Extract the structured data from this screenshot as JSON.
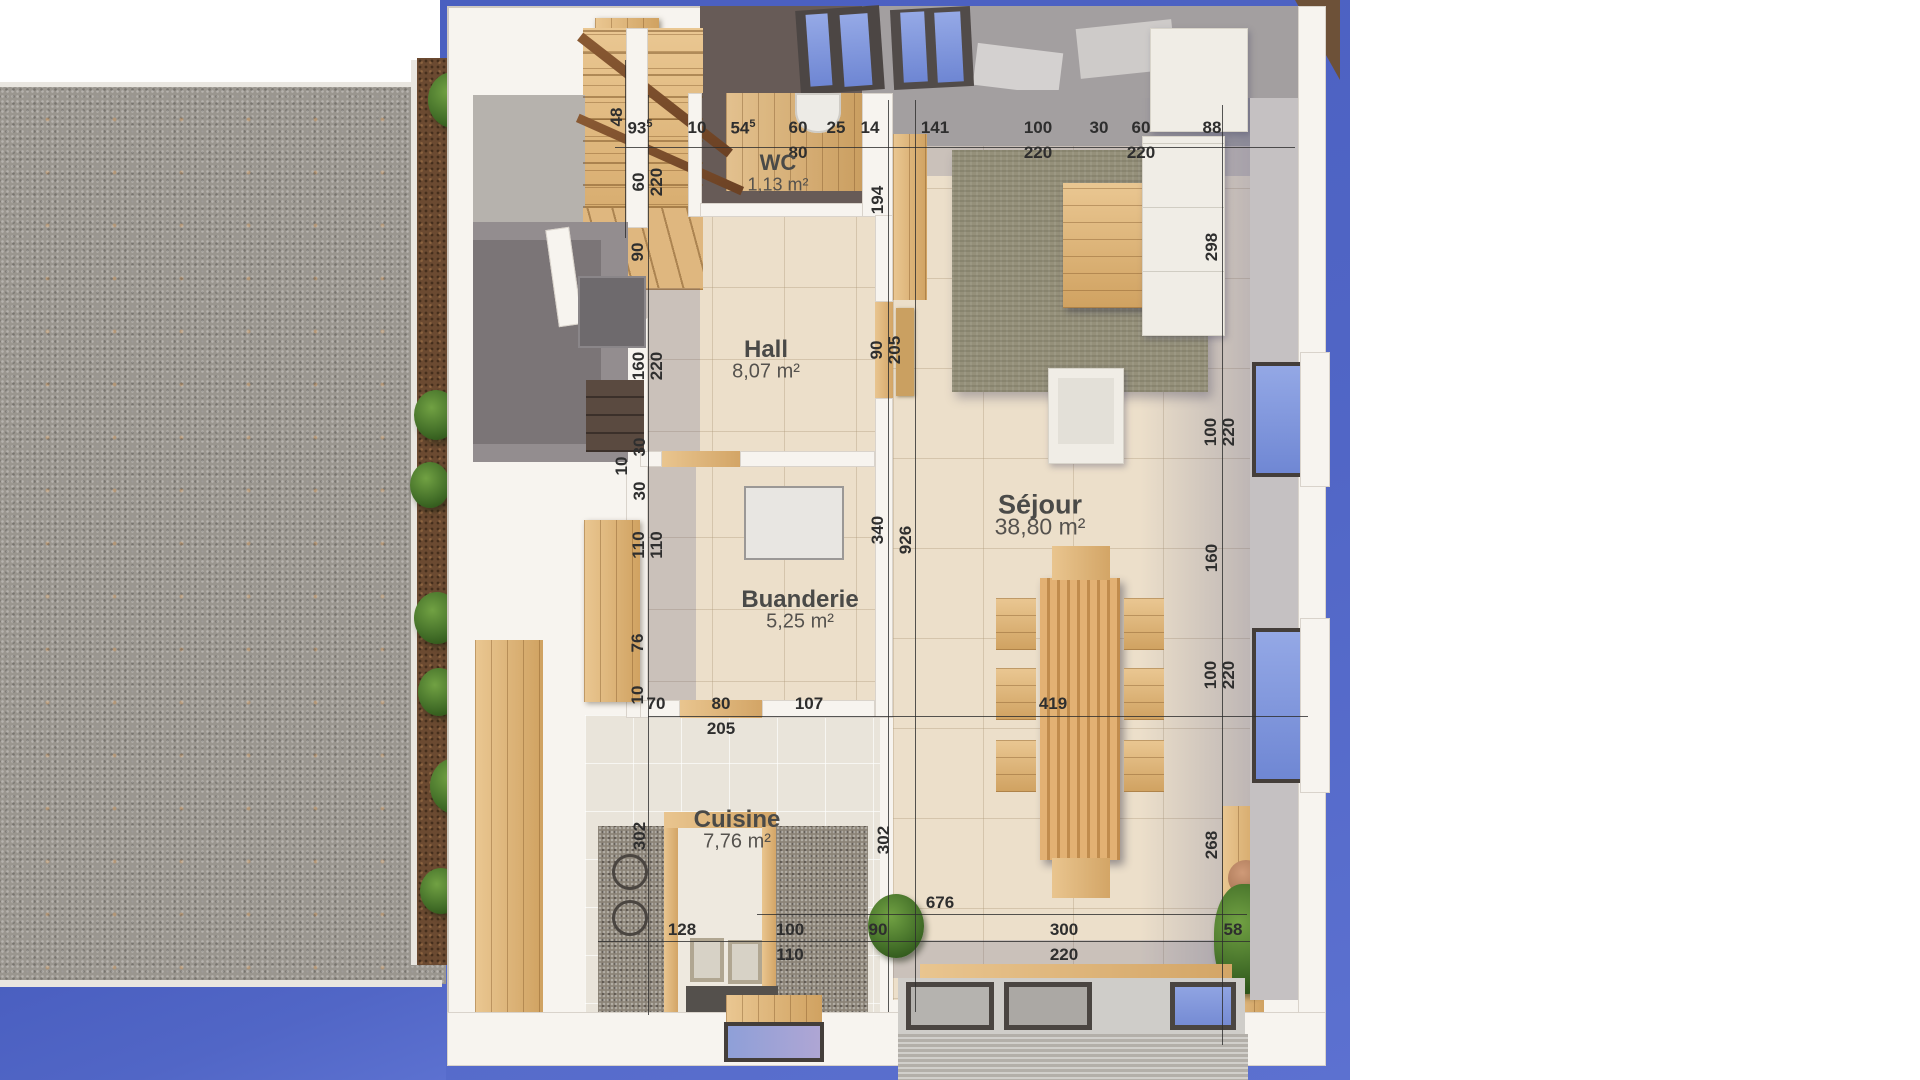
{
  "palette": {
    "blue": "#4e63c3",
    "gravel": "#9a968f",
    "wall_white": "#f7f4ef",
    "tile_beige": "#ecdfca",
    "wood": "#ddb27b",
    "granite": "#8c8478",
    "rug_olive": "#95907a",
    "glass_blue": "#8ba0e0",
    "dim_text": "#2e2e2e"
  },
  "rooms": [
    {
      "id": "wc",
      "name": "WC",
      "area": "1,13 m²",
      "cx": 778,
      "cy": 163,
      "fs": 22
    },
    {
      "id": "hall",
      "name": "Hall",
      "area": "8,07 m²",
      "cx": 766,
      "cy": 350,
      "fs": 24
    },
    {
      "id": "buanderie",
      "name": "Buanderie",
      "area": "5,25 m²",
      "cx": 800,
      "cy": 600,
      "fs": 24
    },
    {
      "id": "cuisine",
      "name": "Cuisine",
      "area": "7,76 m²",
      "cx": 737,
      "cy": 820,
      "fs": 24
    },
    {
      "id": "sejour",
      "name": "Séjour",
      "area": "38,80 m²",
      "cx": 1040,
      "cy": 505,
      "fs": 27
    }
  ],
  "dim_labels": [
    {
      "t": "93",
      "sup": "5",
      "x": 640,
      "y": 128
    },
    {
      "t": "10",
      "x": 697,
      "y": 128
    },
    {
      "t": "54",
      "sup": "5",
      "x": 743,
      "y": 128
    },
    {
      "t": "60",
      "x": 798,
      "y": 128,
      "b": "80"
    },
    {
      "t": "25",
      "x": 836,
      "y": 128
    },
    {
      "t": "14",
      "x": 870,
      "y": 128
    },
    {
      "t": "141",
      "x": 935,
      "y": 128
    },
    {
      "t": "100",
      "x": 1038,
      "y": 128,
      "b": "220"
    },
    {
      "t": "30",
      "x": 1099,
      "y": 128
    },
    {
      "t": "60",
      "x": 1141,
      "y": 128,
      "b": "220"
    },
    {
      "t": "88",
      "x": 1212,
      "y": 128
    },
    {
      "t": "48",
      "x": 617,
      "y": 117,
      "rot": 1
    },
    {
      "t": "60",
      "p": "220",
      "x": 648,
      "y": 182,
      "rot": 1
    },
    {
      "t": "90",
      "x": 638,
      "y": 252,
      "rot": 1
    },
    {
      "t": "160",
      "p": "220",
      "x": 648,
      "y": 366,
      "rot": 1
    },
    {
      "t": "30",
      "x": 640,
      "y": 447,
      "rot": 1
    },
    {
      "t": "10",
      "x": 622,
      "y": 466,
      "rot": 1
    },
    {
      "t": "30",
      "x": 640,
      "y": 491,
      "rot": 1
    },
    {
      "t": "110",
      "p": "110",
      "x": 648,
      "y": 545,
      "rot": 1
    },
    {
      "t": "76",
      "x": 638,
      "y": 643,
      "rot": 1
    },
    {
      "t": "10",
      "x": 638,
      "y": 695,
      "rot": 1
    },
    {
      "t": "302",
      "x": 640,
      "y": 836,
      "rot": 1
    },
    {
      "t": "194",
      "x": 878,
      "y": 200,
      "rot": 1
    },
    {
      "t": "90",
      "p": "205",
      "x": 886,
      "y": 350,
      "rot": 1
    },
    {
      "t": "340",
      "x": 878,
      "y": 530,
      "rot": 1
    },
    {
      "t": "302",
      "x": 884,
      "y": 840,
      "rot": 1
    },
    {
      "t": "926",
      "x": 906,
      "y": 540,
      "rot": 1
    },
    {
      "t": "298",
      "x": 1212,
      "y": 247,
      "rot": 1
    },
    {
      "t": "100",
      "p": "220",
      "x": 1220,
      "y": 432,
      "rot": 1
    },
    {
      "t": "160",
      "x": 1212,
      "y": 558,
      "rot": 1
    },
    {
      "t": "100",
      "p": "220",
      "x": 1220,
      "y": 675,
      "rot": 1
    },
    {
      "t": "268",
      "x": 1212,
      "y": 845,
      "rot": 1
    },
    {
      "t": "70",
      "x": 656,
      "y": 704
    },
    {
      "t": "80",
      "x": 721,
      "y": 704,
      "b": "205"
    },
    {
      "t": "107",
      "x": 809,
      "y": 704
    },
    {
      "t": "419",
      "x": 1053,
      "y": 704
    },
    {
      "t": "676",
      "x": 940,
      "y": 903
    },
    {
      "t": "128",
      "x": 682,
      "y": 930
    },
    {
      "t": "100",
      "x": 790,
      "y": 930,
      "b": "110"
    },
    {
      "t": "90",
      "x": 878,
      "y": 930
    },
    {
      "t": "300",
      "x": 1064,
      "y": 930,
      "b": "220"
    },
    {
      "t": "58",
      "x": 1233,
      "y": 930
    }
  ]
}
